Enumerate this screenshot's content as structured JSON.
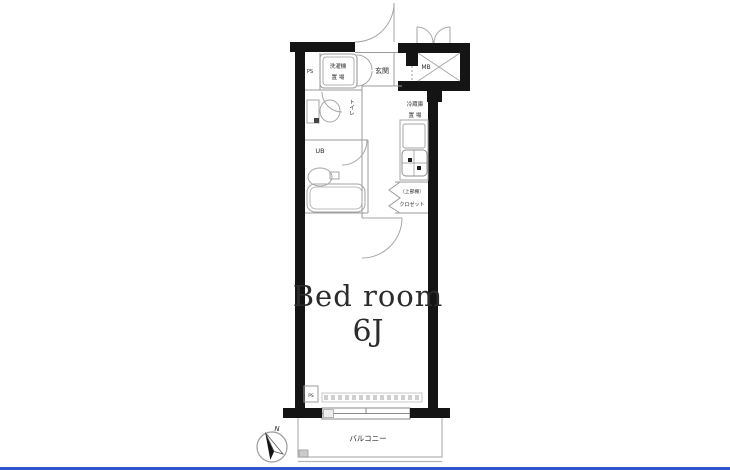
{
  "rooms": {
    "bedroom": {
      "label": "Bed room",
      "size": "6J"
    },
    "balcony": {
      "label": "バルコニー"
    },
    "entrance": {
      "label": "玄関"
    },
    "toilet": {
      "label": "トイレ"
    },
    "unit_bath": {
      "label": "UB"
    },
    "closet": {
      "upper_shelf": "（上部棚）",
      "label": "クロゼット"
    }
  },
  "fixtures": {
    "meter_box": "MB",
    "pipe_space_top": "PS",
    "pipe_space_bottom": "PS",
    "washing_machine": {
      "line1": "洗濯機",
      "line2": "置 場"
    },
    "refrigerator": {
      "line1": "冷蔵庫",
      "line2": "置 場"
    }
  },
  "compass": {
    "north_label": "N"
  },
  "colors": {
    "wall": "#141414",
    "line": "#9b9b9b",
    "fixture_line": "#a6a6a6",
    "text": "#2b2b2b",
    "accent_bar": "#2f55cc",
    "background": "#ffffff"
  }
}
